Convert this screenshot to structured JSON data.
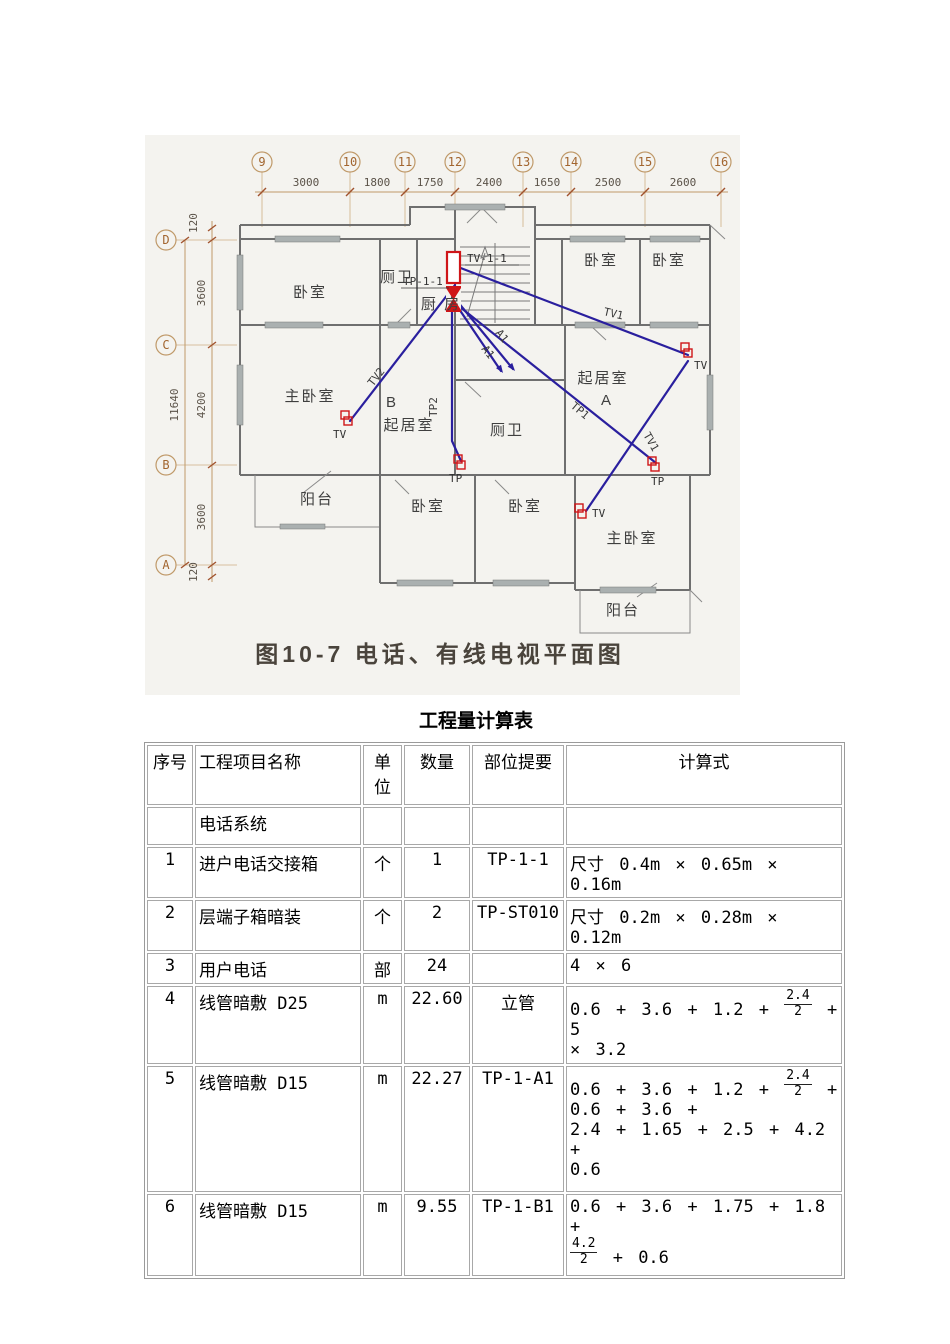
{
  "figure": {
    "caption": "图10-7 电话、有线电视平面图",
    "axes_top": [
      "9",
      "10",
      "11",
      "12",
      "13",
      "14",
      "15",
      "16"
    ],
    "dims_top": [
      "3000",
      "1800",
      "1750",
      "2400",
      "1650",
      "2500",
      "2600"
    ],
    "axes_left": [
      "D",
      "C",
      "B",
      "A"
    ],
    "dims_left": {
      "top_offset": "120",
      "d_c": "3600",
      "c_b": "4200",
      "b_a": "3600",
      "bottom_offset": "120",
      "total": "11640"
    },
    "rooms": {
      "bedroom": "卧室",
      "master_bedroom": "主卧室",
      "living_room": "起居室",
      "kitchen": "厨 房",
      "bathroom": "厕卫",
      "balcony": "阳台",
      "unit_a": "A",
      "unit_b": "B"
    },
    "devices": {
      "tv_box": "TV-1-1",
      "tp_box": "TP-1-1",
      "tv_outlet": "TV",
      "tp_outlet": "TP",
      "tv1": "TV1",
      "tv2": "TV2",
      "tp1": "TP1",
      "tp2": "TP2",
      "a1": "A1"
    }
  },
  "table": {
    "title": "工程量计算表",
    "headers": {
      "no": "序号",
      "name": "工程项目名称",
      "unit": "单位",
      "qty": "数量",
      "loc": "部位提要",
      "formula": "计算式"
    },
    "rows": [
      {
        "no": "",
        "name": "电话系统",
        "unit": "",
        "qty": "",
        "loc": "",
        "formula": ""
      },
      {
        "no": "1",
        "name": "进户电话交接箱",
        "unit": "个",
        "qty": "1",
        "loc": "TP-1-1",
        "formula": "尺寸 0.4m × 0.65m × 0.16m"
      },
      {
        "no": "2",
        "name": "层端子箱暗装",
        "unit": "个",
        "qty": "2",
        "loc": "TP-ST010",
        "formula": "尺寸 0.2m × 0.28m × 0.12m"
      },
      {
        "no": "3",
        "name": "用户电话",
        "unit": "部",
        "qty": "24",
        "loc": "",
        "formula": "4 × 6"
      },
      {
        "no": "4",
        "name": "线管暗敷 D25",
        "unit": "m",
        "qty": "22.60",
        "loc": "立管",
        "formula": "0.6 + 3.6 + 1.2 + {2.4/2} + 5\n× 3.2"
      },
      {
        "no": "5",
        "name": "线管暗敷 D15",
        "unit": "m",
        "qty": "22.27",
        "loc": "TP-1-A1",
        "formula": "0.6 + 3.6 + 1.2 + {2.4/2} +\n0.6 + 3.6 +\n2.4 + 1.65 + 2.5 + 4.2 +\n0.6"
      },
      {
        "no": "6",
        "name": "线管暗敷 D15",
        "unit": "m",
        "qty": "9.55",
        "loc": "TP-1-B1",
        "formula": "0.6 + 3.6 + 1.75 + 1.8 +\n{4.2/2} + 0.6"
      }
    ]
  }
}
